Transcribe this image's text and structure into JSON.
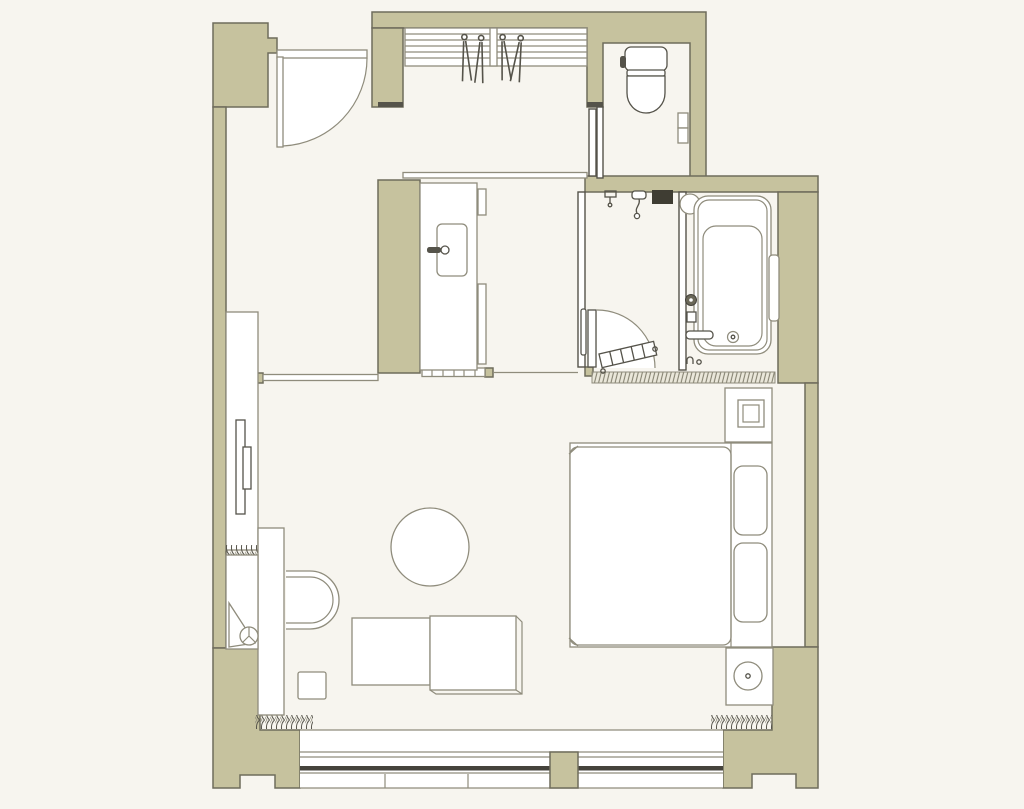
{
  "plan": {
    "kind": "hotel-guestroom-floor-plan",
    "palette": {
      "bg": "#f7f5ef",
      "wall": "#c6c29e",
      "wall_stroke": "#6f6c5c",
      "line": "#8f8c7c",
      "dark": "#55534a",
      "glass": "#45433c",
      "hatch_bg": "#eae7da",
      "white": "#ffffff"
    },
    "rooms": [
      {
        "name": "entrance-hall"
      },
      {
        "name": "closet"
      },
      {
        "name": "toilet-room"
      },
      {
        "name": "vanity-area"
      },
      {
        "name": "shower-room"
      },
      {
        "name": "bathtub-room"
      },
      {
        "name": "bedroom-living-area"
      }
    ],
    "fixtures": [
      {
        "name": "entrance-door",
        "room": "entrance-hall"
      },
      {
        "name": "closet-shelf-with-hangers",
        "room": "closet",
        "hanger_count": 4
      },
      {
        "name": "toilet",
        "room": "toilet-room"
      },
      {
        "name": "toilet-controls",
        "room": "toilet-room"
      },
      {
        "name": "vanity-counter-with-sink",
        "room": "vanity-area"
      },
      {
        "name": "shower-head",
        "room": "shower-room"
      },
      {
        "name": "shower-shelf",
        "room": "shower-room"
      },
      {
        "name": "shower-door-with-duckboard",
        "room": "shower-room"
      },
      {
        "name": "bathtub",
        "room": "bathtub-room"
      },
      {
        "name": "bath-grab-bar",
        "room": "bathtub-room"
      },
      {
        "name": "towel-rail",
        "room": "bathtub-room"
      },
      {
        "name": "tv-cabinet-with-tv",
        "room": "bedroom-living-area"
      },
      {
        "name": "desk",
        "room": "bedroom-living-area"
      },
      {
        "name": "desk-chair",
        "room": "bedroom-living-area"
      },
      {
        "name": "accessory-stand",
        "room": "bedroom-living-area"
      },
      {
        "name": "stool",
        "room": "bedroom-living-area"
      },
      {
        "name": "ottoman-bench",
        "room": "bedroom-living-area"
      },
      {
        "name": "round-table",
        "room": "bedroom-living-area"
      },
      {
        "name": "double-bed-with-pillows",
        "room": "bedroom-living-area",
        "pillow_count": 2
      },
      {
        "name": "nightstand-square-lamp",
        "room": "bedroom-living-area"
      },
      {
        "name": "nightstand-round-lamp",
        "room": "bedroom-living-area"
      },
      {
        "name": "window-wall-with-curtains",
        "room": "bedroom-living-area",
        "curtain_count": 2
      }
    ]
  }
}
